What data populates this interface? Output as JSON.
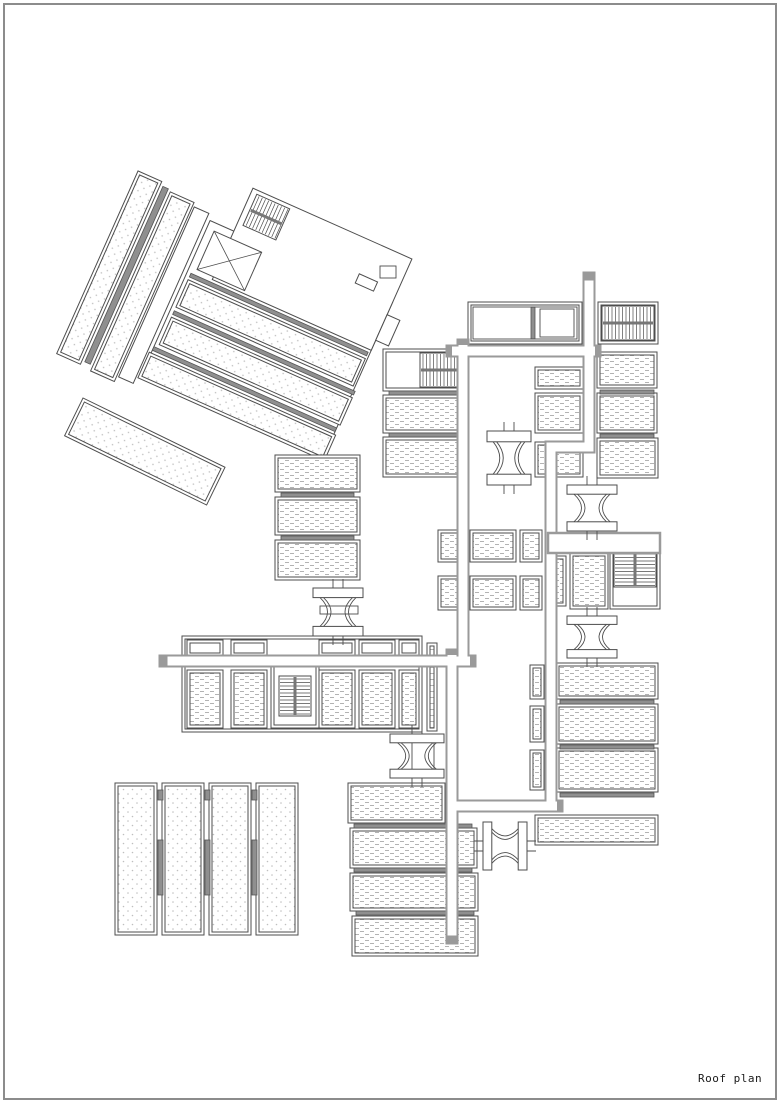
{
  "page": {
    "background": "#ffffff",
    "border_color": "#8c8c8c",
    "title_label": "Roof plan"
  },
  "drawing": {
    "line_color": "#4d4d4d",
    "corridor_edge_color": "#9a9a9a",
    "hatch_dash_color": "#b3b3b3",
    "hatch_dot_color": "#bfbfbf",
    "bar_fill": "#8f8f8f",
    "rotated_block": {
      "tx": 137,
      "ty": 188,
      "angle": 24,
      "els": [
        {
          "t": "rect",
          "x": 80,
          "y": 0,
          "w": 200,
          "h": 170
        },
        {
          "t": "panel",
          "x": -6,
          "y": -16,
          "w": 26,
          "h": 200,
          "hatch": "dot"
        },
        {
          "t": "bar",
          "x": 23,
          "y": -12,
          "w": 6,
          "h": 192
        },
        {
          "t": "panel",
          "x": 32,
          "y": -10,
          "w": 26,
          "h": 196,
          "hatch": "dot"
        },
        {
          "t": "rect",
          "x": 60,
          "y": -6,
          "w": 16,
          "h": 186
        },
        {
          "t": "rect",
          "x": 106,
          "y": -47,
          "w": 174,
          "h": 100
        },
        {
          "t": "stair",
          "x": 112,
          "y": -43,
          "w": 36,
          "h": 34,
          "dir": "v"
        },
        {
          "t": "rect",
          "x": 238,
          "y": -12,
          "w": 20,
          "h": 10
        },
        {
          "t": "xbox",
          "x": 88,
          "y": 8,
          "w": 52,
          "h": 42
        },
        {
          "t": "bar",
          "x": 84,
          "y": 56,
          "w": 194,
          "h": 4
        },
        {
          "t": "panel",
          "x": 84,
          "y": 63,
          "w": 194,
          "h": 30,
          "hatch": "dot"
        },
        {
          "t": "bar",
          "x": 84,
          "y": 97,
          "w": 198,
          "h": 4
        },
        {
          "t": "panel",
          "x": 84,
          "y": 104,
          "w": 198,
          "h": 30,
          "hatch": "dot"
        },
        {
          "t": "bar",
          "x": 80,
          "y": 138,
          "w": 200,
          "h": 4
        },
        {
          "t": "panel",
          "x": 78,
          "y": 145,
          "w": 204,
          "h": 28,
          "hatch": "dot"
        },
        {
          "t": "rect",
          "x": 280,
          "y": 14,
          "w": 14,
          "h": 28
        }
      ]
    },
    "detached_strip": {
      "tx": 83,
      "ty": 398,
      "angle": 26,
      "els": [
        {
          "t": "panel",
          "x": 0,
          "y": 0,
          "w": 158,
          "h": 42,
          "hatch": "dot"
        }
      ]
    },
    "panels": [
      {
        "x": 383,
        "y": 349,
        "w": 80,
        "h": 42,
        "hatch": "none"
      },
      {
        "x": 383,
        "y": 395,
        "w": 80,
        "h": 38,
        "hatch": "dash"
      },
      {
        "x": 383,
        "y": 437,
        "w": 80,
        "h": 40,
        "hatch": "dash"
      },
      {
        "x": 468,
        "y": 302,
        "w": 114,
        "h": 42,
        "hatch": "none"
      },
      {
        "x": 598,
        "y": 302,
        "w": 60,
        "h": 42,
        "hatch": "none"
      },
      {
        "x": 535,
        "y": 367,
        "w": 48,
        "h": 22,
        "hatch": "dash"
      },
      {
        "x": 535,
        "y": 393,
        "w": 48,
        "h": 40,
        "hatch": "dash"
      },
      {
        "x": 535,
        "y": 442,
        "w": 48,
        "h": 35,
        "hatch": "dash"
      },
      {
        "x": 597,
        "y": 352,
        "w": 60,
        "h": 36,
        "hatch": "dash"
      },
      {
        "x": 597,
        "y": 393,
        "w": 60,
        "h": 40,
        "hatch": "dash"
      },
      {
        "x": 597,
        "y": 438,
        "w": 61,
        "h": 40,
        "hatch": "dash"
      },
      {
        "x": 438,
        "y": 530,
        "w": 26,
        "h": 32,
        "hatch": "dash"
      },
      {
        "x": 470,
        "y": 530,
        "w": 46,
        "h": 32,
        "hatch": "dash"
      },
      {
        "x": 520,
        "y": 530,
        "w": 22,
        "h": 32,
        "hatch": "dash"
      },
      {
        "x": 438,
        "y": 576,
        "w": 26,
        "h": 34,
        "hatch": "dash"
      },
      {
        "x": 470,
        "y": 576,
        "w": 46,
        "h": 34,
        "hatch": "dash"
      },
      {
        "x": 520,
        "y": 576,
        "w": 22,
        "h": 34,
        "hatch": "dash"
      },
      {
        "x": 275,
        "y": 455,
        "w": 85,
        "h": 37,
        "hatch": "dash"
      },
      {
        "x": 275,
        "y": 497,
        "w": 85,
        "h": 38,
        "hatch": "dash"
      },
      {
        "x": 275,
        "y": 540,
        "w": 85,
        "h": 40,
        "hatch": "dash"
      },
      {
        "x": 182,
        "y": 636,
        "w": 240,
        "h": 96,
        "hatch": "none"
      },
      {
        "x": 187,
        "y": 640,
        "w": 36,
        "h": 16,
        "hatch": "none"
      },
      {
        "x": 231,
        "y": 640,
        "w": 36,
        "h": 16,
        "hatch": "none"
      },
      {
        "x": 319,
        "y": 640,
        "w": 36,
        "h": 16,
        "hatch": "none"
      },
      {
        "x": 359,
        "y": 640,
        "w": 36,
        "h": 16,
        "hatch": "none"
      },
      {
        "x": 399,
        "y": 640,
        "w": 20,
        "h": 16,
        "hatch": "none"
      },
      {
        "x": 187,
        "y": 670,
        "w": 36,
        "h": 58,
        "hatch": "dash"
      },
      {
        "x": 231,
        "y": 670,
        "w": 36,
        "h": 58,
        "hatch": "dash"
      },
      {
        "x": 271,
        "y": 662,
        "w": 48,
        "h": 66,
        "hatch": "none"
      },
      {
        "x": 319,
        "y": 670,
        "w": 36,
        "h": 58,
        "hatch": "dash"
      },
      {
        "x": 359,
        "y": 670,
        "w": 36,
        "h": 58,
        "hatch": "dash"
      },
      {
        "x": 399,
        "y": 670,
        "w": 20,
        "h": 58,
        "hatch": "dash"
      },
      {
        "x": 427,
        "y": 643,
        "w": 10,
        "h": 88,
        "hatch": "dash"
      },
      {
        "x": 570,
        "y": 553,
        "w": 38,
        "h": 56,
        "hatch": "dash"
      },
      {
        "x": 552,
        "y": 556,
        "w": 14,
        "h": 50,
        "hatch": "dash"
      },
      {
        "x": 610,
        "y": 547,
        "w": 50,
        "h": 62,
        "hatch": "none"
      },
      {
        "x": 556,
        "y": 663,
        "w": 102,
        "h": 36,
        "hatch": "dash"
      },
      {
        "x": 556,
        "y": 704,
        "w": 102,
        "h": 40,
        "hatch": "dash"
      },
      {
        "x": 556,
        "y": 748,
        "w": 102,
        "h": 44,
        "hatch": "dash"
      },
      {
        "x": 535,
        "y": 815,
        "w": 123,
        "h": 30,
        "hatch": "dash"
      },
      {
        "x": 530,
        "y": 665,
        "w": 14,
        "h": 34,
        "hatch": "dash"
      },
      {
        "x": 530,
        "y": 706,
        "w": 14,
        "h": 36,
        "hatch": "dash"
      },
      {
        "x": 530,
        "y": 750,
        "w": 14,
        "h": 40,
        "hatch": "dash"
      },
      {
        "x": 348,
        "y": 783,
        "w": 97,
        "h": 40,
        "hatch": "dash"
      },
      {
        "x": 350,
        "y": 828,
        "w": 127,
        "h": 40,
        "hatch": "dash"
      },
      {
        "x": 350,
        "y": 873,
        "w": 128,
        "h": 38,
        "hatch": "dash"
      },
      {
        "x": 352,
        "y": 916,
        "w": 126,
        "h": 40,
        "hatch": "dash"
      },
      {
        "x": 115,
        "y": 783,
        "w": 42,
        "h": 152,
        "hatch": "dot"
      },
      {
        "x": 162,
        "y": 783,
        "w": 42,
        "h": 152,
        "hatch": "dot"
      },
      {
        "x": 209,
        "y": 783,
        "w": 42,
        "h": 152,
        "hatch": "dot"
      },
      {
        "x": 256,
        "y": 783,
        "w": 42,
        "h": 152,
        "hatch": "dot"
      }
    ],
    "bars": [
      {
        "x": 389,
        "y": 391,
        "w": 68,
        "h": 4
      },
      {
        "x": 389,
        "y": 433,
        "w": 68,
        "h": 4
      },
      {
        "x": 600,
        "y": 390,
        "w": 54,
        "h": 4
      },
      {
        "x": 600,
        "y": 434,
        "w": 54,
        "h": 4
      },
      {
        "x": 281,
        "y": 493,
        "w": 73,
        "h": 4
      },
      {
        "x": 281,
        "y": 536,
        "w": 73,
        "h": 4
      },
      {
        "x": 560,
        "y": 700,
        "w": 94,
        "h": 4
      },
      {
        "x": 560,
        "y": 745,
        "w": 94,
        "h": 4
      },
      {
        "x": 560,
        "y": 793,
        "w": 94,
        "h": 4
      },
      {
        "x": 354,
        "y": 824,
        "w": 118,
        "h": 4
      },
      {
        "x": 354,
        "y": 868,
        "w": 118,
        "h": 4
      },
      {
        "x": 356,
        "y": 911,
        "w": 118,
        "h": 4
      },
      {
        "x": 158,
        "y": 840,
        "w": 5,
        "h": 55
      },
      {
        "x": 205,
        "y": 840,
        "w": 5,
        "h": 55
      },
      {
        "x": 252,
        "y": 840,
        "w": 5,
        "h": 55
      },
      {
        "x": 158,
        "y": 790,
        "w": 5,
        "h": 10
      },
      {
        "x": 205,
        "y": 790,
        "w": 5,
        "h": 10
      },
      {
        "x": 252,
        "y": 790,
        "w": 5,
        "h": 10
      },
      {
        "x": 531,
        "y": 307,
        "w": 4,
        "h": 32
      }
    ],
    "stairs": [
      {
        "x": 420,
        "y": 353,
        "w": 38,
        "h": 34,
        "dir": "v"
      },
      {
        "x": 602,
        "y": 306,
        "w": 52,
        "h": 34,
        "dir": "v"
      },
      {
        "x": 279,
        "y": 676,
        "w": 32,
        "h": 40,
        "dir": "h"
      },
      {
        "x": 614,
        "y": 551,
        "w": 42,
        "h": 36,
        "dir": "h"
      }
    ],
    "solid_bars": [
      {
        "x": 548,
        "y": 533,
        "w": 112,
        "h": 20
      }
    ],
    "extras": [
      {
        "x": 473,
        "y": 307,
        "w": 104,
        "h": 32
      },
      {
        "x": 540,
        "y": 309,
        "w": 34,
        "h": 28
      },
      {
        "x": 380,
        "y": 266,
        "w": 16,
        "h": 12
      },
      {
        "x": 412,
        "y": 738,
        "w": 22,
        "h": 38
      },
      {
        "x": 320,
        "y": 606,
        "w": 38,
        "h": 8
      }
    ],
    "spools": [
      {
        "cx": 509,
        "cy": 458,
        "w": 44,
        "h": 54,
        "o": "v"
      },
      {
        "cx": 592,
        "cy": 508,
        "w": 50,
        "h": 46,
        "o": "v"
      },
      {
        "cx": 338,
        "cy": 612,
        "w": 50,
        "h": 48,
        "o": "v"
      },
      {
        "cx": 592,
        "cy": 637,
        "w": 50,
        "h": 42,
        "o": "v"
      },
      {
        "cx": 417,
        "cy": 756,
        "w": 54,
        "h": 44,
        "o": "v"
      },
      {
        "cx": 505,
        "cy": 846,
        "w": 44,
        "h": 48,
        "o": "h"
      }
    ],
    "corridors": [
      {
        "pts": [
          [
            589,
            278
          ],
          [
            589,
            447
          ],
          [
            551,
            447
          ],
          [
            551,
            806
          ]
        ],
        "cap_start": true
      },
      {
        "pts": [
          [
            452,
            351
          ],
          [
            595,
            351
          ]
        ]
      },
      {
        "pts": [
          [
            463,
            345
          ],
          [
            463,
            661
          ]
        ]
      },
      {
        "pts": [
          [
            165,
            661
          ],
          [
            470,
            661
          ]
        ],
        "cap_start": true
      },
      {
        "pts": [
          [
            452,
            655
          ],
          [
            452,
            938
          ]
        ],
        "cap_end": true
      },
      {
        "pts": [
          [
            452,
            806
          ],
          [
            557,
            806
          ]
        ]
      }
    ]
  }
}
